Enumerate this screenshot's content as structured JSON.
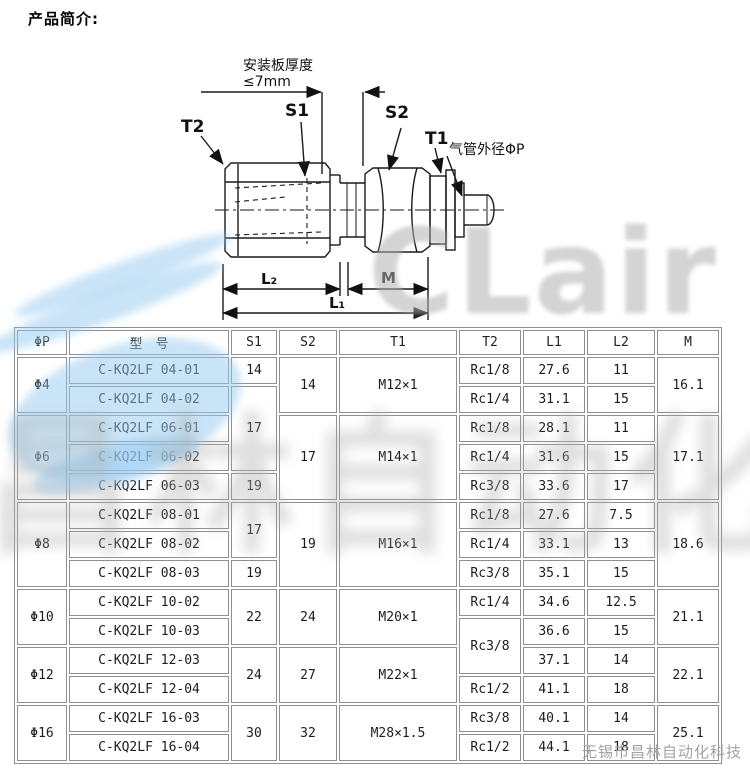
{
  "page": {
    "title": "产品简介:"
  },
  "diagram": {
    "labels": {
      "plate_thickness_1": "安装板厚度",
      "plate_thickness_2": "≤7mm",
      "t2": "T2",
      "s1": "S1",
      "s2": "S2",
      "t1": "T1",
      "tube_od": "气管外径ΦP",
      "l2": "L₂",
      "m": "M",
      "l1": "L₁"
    }
  },
  "watermark": {
    "logo_text": "CLair",
    "cjk_text": "昌林自动化",
    "footer_text": "无锡市昌林自动化科技",
    "blue": "#96caf0",
    "gray": "#b0b0b0"
  },
  "table": {
    "headers": [
      "ΦP",
      "型　号",
      "S1",
      "S2",
      "T1",
      "T2",
      "L1",
      "L2",
      "M"
    ],
    "rows": [
      [
        {
          "t": "Φ4",
          "rs": 2
        },
        {
          "t": "C-KQ2LF 04-01"
        },
        {
          "t": "14"
        },
        {
          "t": "14",
          "rs": 2
        },
        {
          "t": "M12×1",
          "rs": 2
        },
        {
          "t": "Rc1/8"
        },
        {
          "t": "27.6"
        },
        {
          "t": "11"
        },
        {
          "t": "16.1",
          "rs": 2
        }
      ],
      [
        {
          "t": "C-KQ2LF 04-02"
        },
        {
          "t": "17",
          "rs": 3
        },
        {
          "t": "Rc1/4"
        },
        {
          "t": "31.1"
        },
        {
          "t": "15"
        }
      ],
      [
        {
          "t": "Φ6",
          "rs": 3
        },
        {
          "t": "C-KQ2LF 06-01"
        },
        {
          "t": "17",
          "rs": 3
        },
        {
          "t": "M14×1",
          "rs": 3
        },
        {
          "t": "Rc1/8"
        },
        {
          "t": "28.1"
        },
        {
          "t": "11"
        },
        {
          "t": "17.1",
          "rs": 3
        }
      ],
      [
        {
          "t": "C-KQ2LF 06-02"
        },
        {
          "t": "Rc1/4"
        },
        {
          "t": "31.6"
        },
        {
          "t": "15"
        }
      ],
      [
        {
          "t": "C-KQ2LF 06-03"
        },
        {
          "t": "19"
        },
        {
          "t": "Rc3/8"
        },
        {
          "t": "33.6"
        },
        {
          "t": "17"
        }
      ],
      [
        {
          "t": "Φ8",
          "rs": 3
        },
        {
          "t": "C-KQ2LF 08-01"
        },
        {
          "t": "17",
          "rs": 2
        },
        {
          "t": "19",
          "rs": 3
        },
        {
          "t": "M16×1",
          "rs": 3
        },
        {
          "t": "Rc1/8"
        },
        {
          "t": "27.6"
        },
        {
          "t": "7.5"
        },
        {
          "t": "18.6",
          "rs": 3
        }
      ],
      [
        {
          "t": "C-KQ2LF 08-02"
        },
        {
          "t": "Rc1/4"
        },
        {
          "t": "33.1"
        },
        {
          "t": "13"
        }
      ],
      [
        {
          "t": "C-KQ2LF 08-03"
        },
        {
          "t": "19"
        },
        {
          "t": "Rc3/8"
        },
        {
          "t": "35.1"
        },
        {
          "t": "15"
        }
      ],
      [
        {
          "t": "Φ10",
          "rs": 2
        },
        {
          "t": "C-KQ2LF 10-02"
        },
        {
          "t": "22",
          "rs": 2
        },
        {
          "t": "24",
          "rs": 2
        },
        {
          "t": "M20×1",
          "rs": 2
        },
        {
          "t": "Rc1/4"
        },
        {
          "t": "34.6"
        },
        {
          "t": "12.5"
        },
        {
          "t": "21.1",
          "rs": 2
        }
      ],
      [
        {
          "t": "C-KQ2LF 10-03"
        },
        {
          "t": "Rc3/8",
          "rs": 2
        },
        {
          "t": "36.6"
        },
        {
          "t": "15"
        }
      ],
      [
        {
          "t": "Φ12",
          "rs": 2
        },
        {
          "t": "C-KQ2LF 12-03"
        },
        {
          "t": "24",
          "rs": 2
        },
        {
          "t": "27",
          "rs": 2
        },
        {
          "t": "M22×1",
          "rs": 2
        },
        {
          "t": "37.1"
        },
        {
          "t": "14"
        },
        {
          "t": "22.1",
          "rs": 2
        }
      ],
      [
        {
          "t": "C-KQ2LF 12-04"
        },
        {
          "t": "Rc1/2"
        },
        {
          "t": "41.1"
        },
        {
          "t": "18"
        }
      ],
      [
        {
          "t": "Φ16",
          "rs": 2
        },
        {
          "t": "C-KQ2LF 16-03"
        },
        {
          "t": "30",
          "rs": 2
        },
        {
          "t": "32",
          "rs": 2
        },
        {
          "t": "M28×1.5",
          "rs": 2
        },
        {
          "t": "Rc3/8"
        },
        {
          "t": "40.1"
        },
        {
          "t": "14"
        },
        {
          "t": "25.1",
          "rs": 2
        }
      ],
      [
        {
          "t": "C-KQ2LF 16-04"
        },
        {
          "t": "Rc1/2"
        },
        {
          "t": "44.1"
        },
        {
          "t": "18"
        }
      ]
    ]
  }
}
